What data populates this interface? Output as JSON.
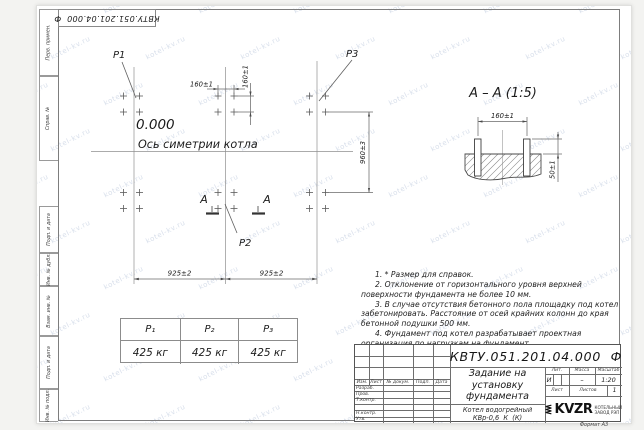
{
  "watermark": {
    "text": "kotel-kv.ru"
  },
  "stamp_top": {
    "text": "КВТУ.051.201.04.000  Ф"
  },
  "side_labels": [
    "Перв. примен.",
    "Справ. №",
    "Подп. и дата",
    "Инв. № дубл.",
    "Взам. инв. №",
    "Подп. и дата",
    "Инв. № подл."
  ],
  "plan": {
    "elevation": "0.000",
    "axis_label": "Ось симетрии котла",
    "p1": "P1",
    "p2": "P2",
    "p3": "P3",
    "dim_160h": "160±1",
    "dim_160v": "160±1",
    "dim_960": "960±3",
    "dim_925a": "925±2",
    "dim_925b": "925±2",
    "section_letter": "А"
  },
  "section": {
    "title": "А – А (1:5)",
    "dim_160": "160±1",
    "dim_50": "50±1"
  },
  "weight_table": {
    "headers": [
      "P₁",
      "P₂",
      "P₃"
    ],
    "values": [
      "425 кг",
      "425 кг",
      "425 кг"
    ]
  },
  "notes": [
    "1. * Размер для справок.",
    "2. Отклонение от горизонтального уровня верхней поверхности фундамента не более 10 мм.",
    "3. В случае отсутствия бетонного пола площадку под котел забетонировать. Расстояние от осей крайних колонн до края бетонной подушки 500 мм.",
    "4. Фундамент под котел разрабатывает проектная организация по нагрузкам на фундамент."
  ],
  "title_block": {
    "doc_number": "КВТУ.051.201.04.000  Ф",
    "title_lines": [
      "Задание на",
      "установку",
      "фундамента"
    ],
    "product_lines": [
      "Котел водогрейный",
      "КВр-0,6  К  (К)"
    ],
    "header_cols": [
      "Изм.",
      "Лист",
      "№ докум.",
      "Подп.",
      "Дата"
    ],
    "rows": [
      "Разраб.",
      "Пров.",
      "Т.контр.",
      "",
      "Н.контр.",
      "Утв."
    ],
    "lit_label": "Лит.",
    "lit_value": "И",
    "mass_label": "Масса",
    "mass_value": "–",
    "scale_label": "Масштаб",
    "scale_value": "1:20",
    "sheet_label": "Лист",
    "sheets_label": "Листов",
    "sheets_value": "1",
    "logo_text": "KVZR",
    "logo_caption_lines": [
      "КОТЕЛЬНЫЙ",
      "ЗАВОД РЭП"
    ],
    "format_label": "Формат А3"
  }
}
